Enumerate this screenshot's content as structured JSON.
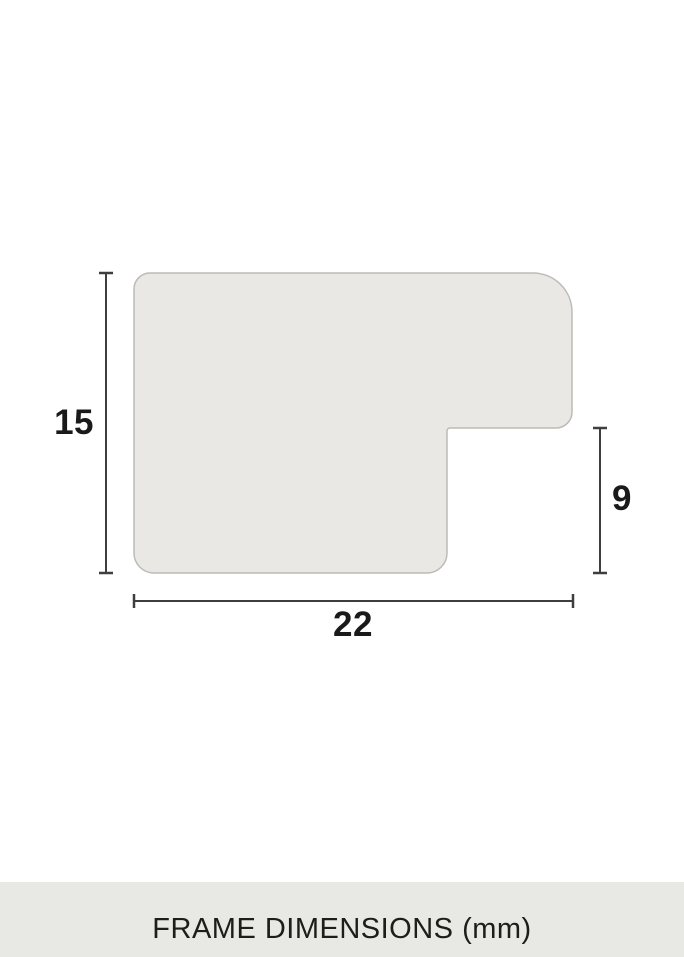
{
  "diagram": {
    "caption": "FRAME DIMENSIONS (mm)",
    "dimensions": {
      "height_mm": "15",
      "rabbet_depth_mm": "9",
      "width_mm": "22"
    }
  },
  "colors": {
    "background": "#ffffff",
    "shape_fill": "#e9e8e4",
    "shape_stroke": "#bcbbb7",
    "dimension_line": "#3e3e3e",
    "label_text": "#1a1a1a",
    "band_background": "#e8e8e5",
    "band_text": "#1d1d1b"
  }
}
